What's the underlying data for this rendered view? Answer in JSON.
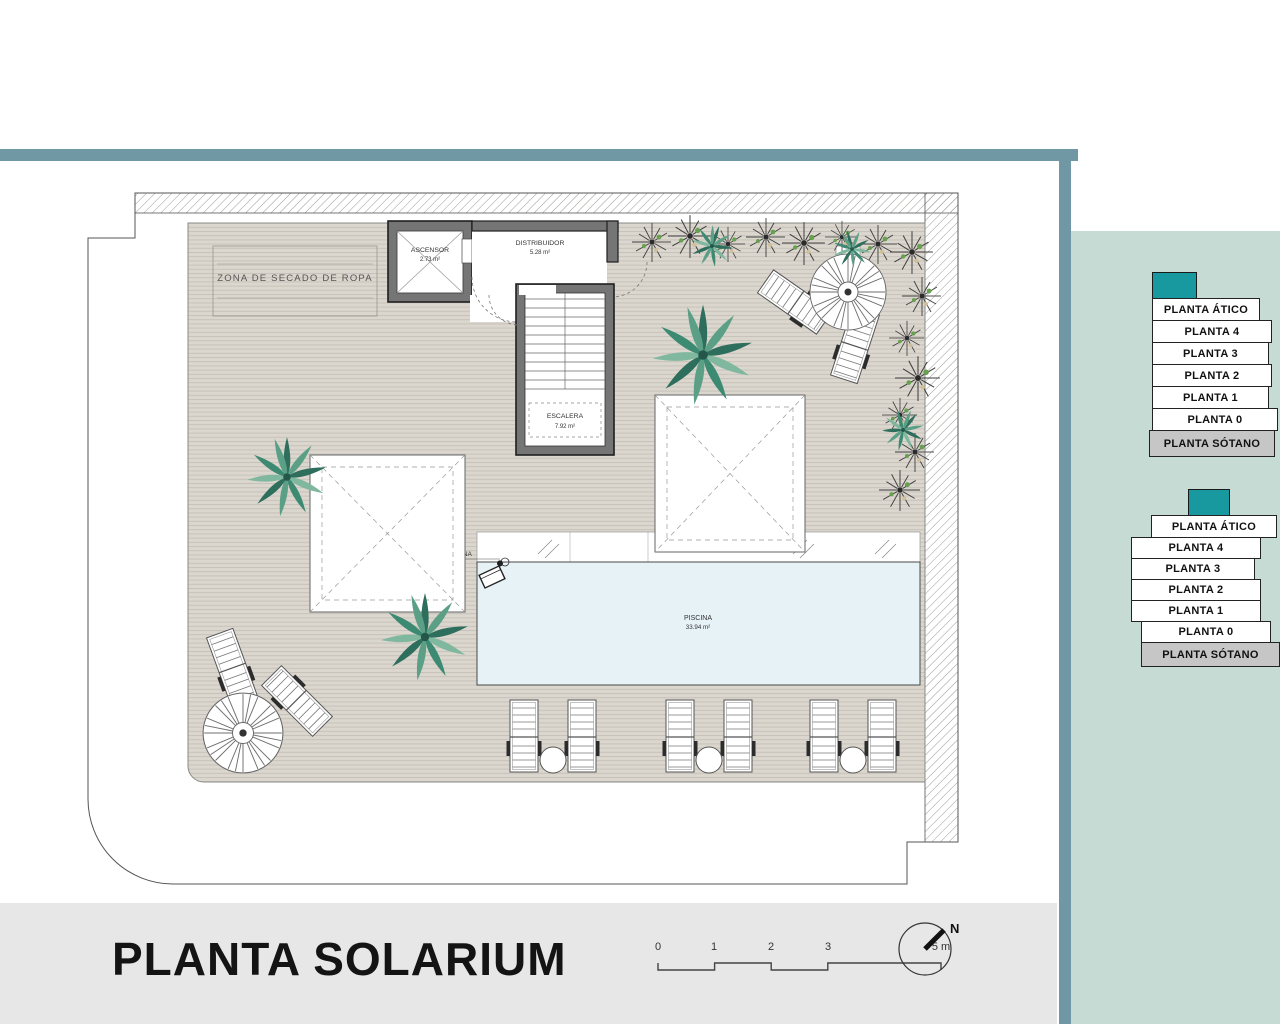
{
  "title_block": {
    "title": "PLANTA SOLARIUM",
    "scale_ticks": [
      "0",
      "1",
      "2",
      "3",
      "5 m"
    ],
    "north_label": "N"
  },
  "plan": {
    "zona_secado": "ZONA DE SECADO DE ROPA",
    "ascensor": {
      "name": "ASCENSOR",
      "area": "2.73 m²"
    },
    "distribuidor": {
      "name": "DISTRIBUIDOR",
      "area": "5.28 m²"
    },
    "escalera": {
      "name": "ESCALERA",
      "area": "7.92 m²"
    },
    "grua": "GRÚA ELEVABLE DE PISCINA",
    "piscina": {
      "name": "PISCINA",
      "area": "33.94 m²"
    }
  },
  "floor_selector": {
    "floors": [
      "PLANTA ÁTICO",
      "PLANTA 4",
      "PLANTA 3",
      "PLANTA 2",
      "PLANTA 1",
      "PLANTA 0",
      "PLANTA SÓTANO"
    ]
  },
  "colors": {
    "accent_teal": "#18989f",
    "frame_teal": "#6f98a4",
    "panel_bg": "#c5dbd3",
    "pool_blue": "#e7f2f7",
    "deck_beige": "#dbd6ce",
    "bottom_bar": "#e7e7e7"
  }
}
